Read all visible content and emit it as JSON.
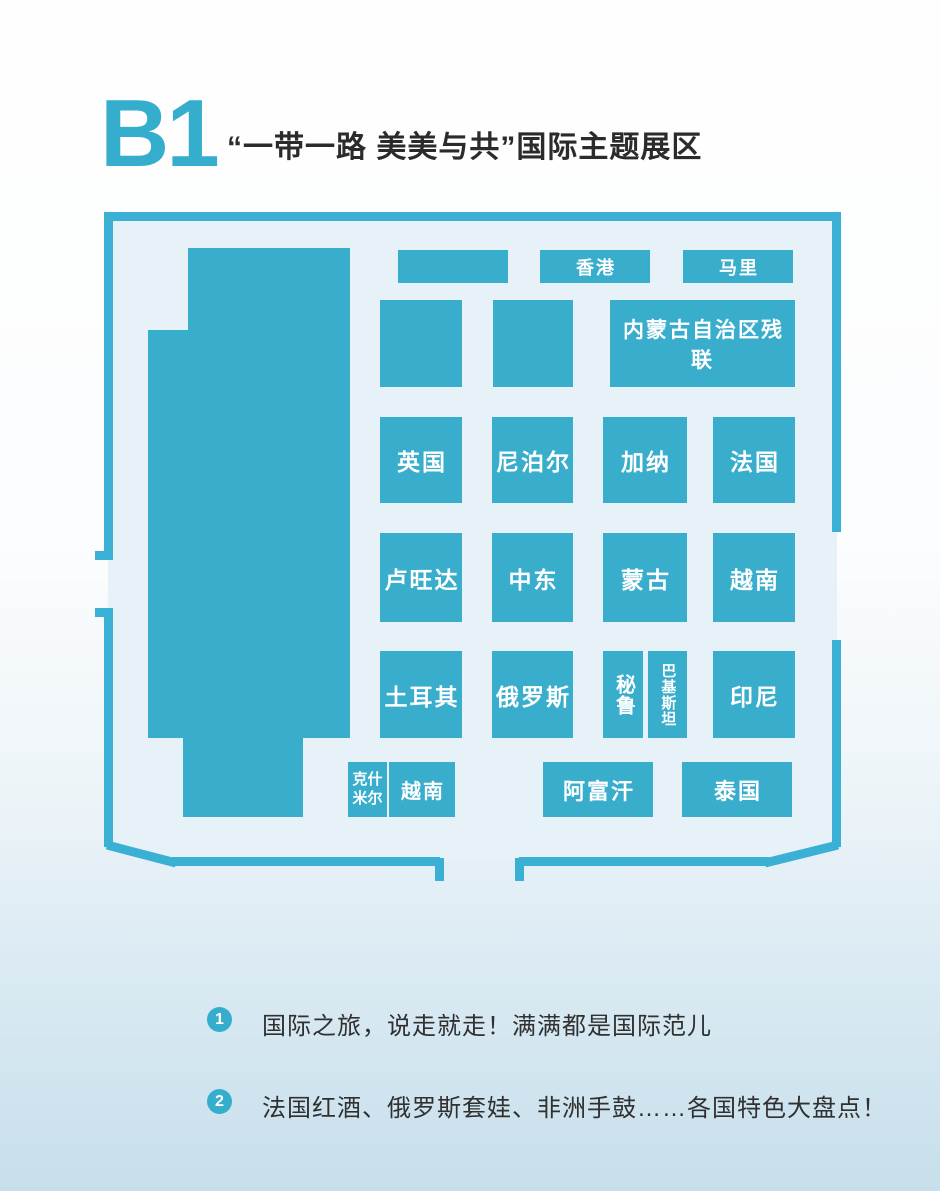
{
  "header": {
    "section_code": "B1",
    "section_title": "“一带一路 美美与共”国际主题展区"
  },
  "colors": {
    "accent": "#35aecd",
    "wall": "#3ab1d4",
    "booth_fill": "#38adcc",
    "floor_fill": "#e7f1f8",
    "title_ink": "#2b2b2b",
    "page_bottom": "#c7dfec"
  },
  "plan": {
    "booths": [
      {
        "id": "unlabeled-top",
        "label": "",
        "x": 308,
        "y": 45,
        "w": 110,
        "h": 33,
        "fs": 18,
        "variant": ""
      },
      {
        "id": "hongkong",
        "label": "香港",
        "x": 450,
        "y": 45,
        "w": 110,
        "h": 33,
        "fs": 18,
        "variant": ""
      },
      {
        "id": "mali",
        "label": "马里",
        "x": 593,
        "y": 45,
        "w": 110,
        "h": 33,
        "fs": 18,
        "variant": ""
      },
      {
        "id": "unlabeled-mid-1",
        "label": "",
        "x": 290,
        "y": 95,
        "w": 82,
        "h": 87,
        "fs": 18,
        "variant": ""
      },
      {
        "id": "unlabeled-mid-2",
        "label": "",
        "x": 403,
        "y": 95,
        "w": 80,
        "h": 87,
        "fs": 18,
        "variant": ""
      },
      {
        "id": "neimenggu-canlian",
        "label": "内蒙古自治区残联",
        "x": 520,
        "y": 95,
        "w": 185,
        "h": 87,
        "fs": 21,
        "variant": ""
      },
      {
        "id": "yingguo",
        "label": "英国",
        "x": 290,
        "y": 212,
        "w": 82,
        "h": 86,
        "fs": 23,
        "variant": ""
      },
      {
        "id": "niboer",
        "label": "尼泊尔",
        "x": 402,
        "y": 212,
        "w": 81,
        "h": 86,
        "fs": 23,
        "variant": ""
      },
      {
        "id": "jiana",
        "label": "加纳",
        "x": 513,
        "y": 212,
        "w": 84,
        "h": 86,
        "fs": 23,
        "variant": ""
      },
      {
        "id": "faguo",
        "label": "法国",
        "x": 623,
        "y": 212,
        "w": 82,
        "h": 86,
        "fs": 23,
        "variant": ""
      },
      {
        "id": "luwangda",
        "label": "卢旺达",
        "x": 290,
        "y": 328,
        "w": 82,
        "h": 89,
        "fs": 23,
        "variant": ""
      },
      {
        "id": "zhongdong",
        "label": "中东",
        "x": 402,
        "y": 328,
        "w": 81,
        "h": 89,
        "fs": 23,
        "variant": ""
      },
      {
        "id": "menggu",
        "label": "蒙古",
        "x": 513,
        "y": 328,
        "w": 84,
        "h": 89,
        "fs": 23,
        "variant": ""
      },
      {
        "id": "yuenan-east",
        "label": "越南",
        "x": 623,
        "y": 328,
        "w": 82,
        "h": 89,
        "fs": 23,
        "variant": ""
      },
      {
        "id": "tuerqi",
        "label": "土耳其",
        "x": 290,
        "y": 446,
        "w": 82,
        "h": 87,
        "fs": 23,
        "variant": ""
      },
      {
        "id": "eluosi",
        "label": "俄罗斯",
        "x": 402,
        "y": 446,
        "w": 81,
        "h": 87,
        "fs": 23,
        "variant": ""
      },
      {
        "id": "bilu",
        "label": "秘鲁",
        "x": 513,
        "y": 446,
        "w": 40,
        "h": 87,
        "fs": 20,
        "variant": "vertical"
      },
      {
        "id": "bajisitan",
        "label": "巴基斯坦",
        "x": 558,
        "y": 446,
        "w": 39,
        "h": 87,
        "fs": 15,
        "variant": "vertical"
      },
      {
        "id": "yinni",
        "label": "印尼",
        "x": 623,
        "y": 446,
        "w": 82,
        "h": 87,
        "fs": 23,
        "variant": ""
      },
      {
        "id": "keshimier",
        "label": "克什\n米尔",
        "x": 258,
        "y": 557,
        "w": 39,
        "h": 55,
        "fs": 15,
        "variant": "twoline"
      },
      {
        "id": "yuenan-south",
        "label": "越南",
        "x": 299,
        "y": 557,
        "w": 66,
        "h": 55,
        "fs": 20,
        "variant": ""
      },
      {
        "id": "afuhan",
        "label": "阿富汗",
        "x": 453,
        "y": 557,
        "w": 110,
        "h": 55,
        "fs": 22,
        "variant": ""
      },
      {
        "id": "taiguo",
        "label": "泰国",
        "x": 592,
        "y": 557,
        "w": 110,
        "h": 55,
        "fs": 22,
        "variant": ""
      }
    ]
  },
  "notes": [
    {
      "num": "1",
      "text": "国际之旅，说走就走！满满都是国际范儿"
    },
    {
      "num": "2",
      "text": "法国红酒、俄罗斯套娃、非洲手鼓……各国特色大盘点！"
    }
  ]
}
